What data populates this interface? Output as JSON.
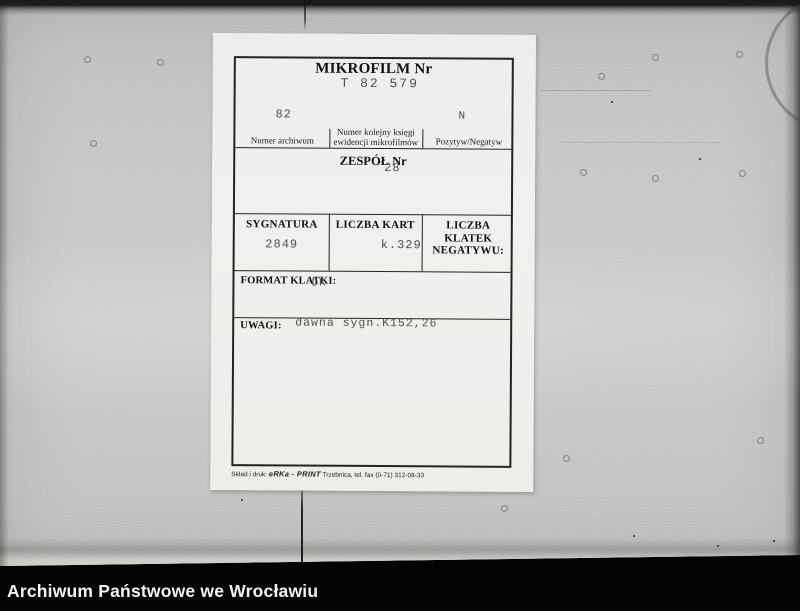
{
  "colors": {
    "photo_gray": "#c6c6c4",
    "card_white": "#efefec",
    "typewriter_ink": "#4e4e4c",
    "print_ink": "#111111",
    "caption_bar": "#000000",
    "caption_text": "#ffffff"
  },
  "card": {
    "title": "MIKROFILM Nr",
    "microfilm_no": "T 82 579",
    "archive_row": {
      "numer_archiwum_value": "82",
      "pozytyw_negatyw_value": "N",
      "col1_label": "Numer archiwum",
      "col2_label_line1": "Numer kolejny księgi",
      "col2_label_line2": "ewidencji mikrofilmów",
      "col3_label": "Pozytyw/Negatyw"
    },
    "zespol": {
      "label": "ZESPÓŁ Nr",
      "value": "28"
    },
    "sygnatura": {
      "label": "SYGNATURA",
      "value": "2849"
    },
    "liczba_kart": {
      "label": "LICZBA KART",
      "value": "k.329"
    },
    "liczba_klatek": {
      "label_line1": "LICZBA KLATEK",
      "label_line2": "NEGATYWU:",
      "value": ""
    },
    "format_klatki": {
      "label": "FORMAT KLATKI:",
      "value": "DK"
    },
    "uwagi": {
      "label": "UWAGI:",
      "value": "dawna sygn.K152,26"
    },
    "print_credit": {
      "prefix": "Skład i druk: ",
      "brand": "eRKa - PRINT",
      "suffix": " Trzebnica, tel. fax (0-71) 312-08-33"
    }
  },
  "footer": {
    "label": "Archiwum Państwowe we Wrocławiu"
  }
}
